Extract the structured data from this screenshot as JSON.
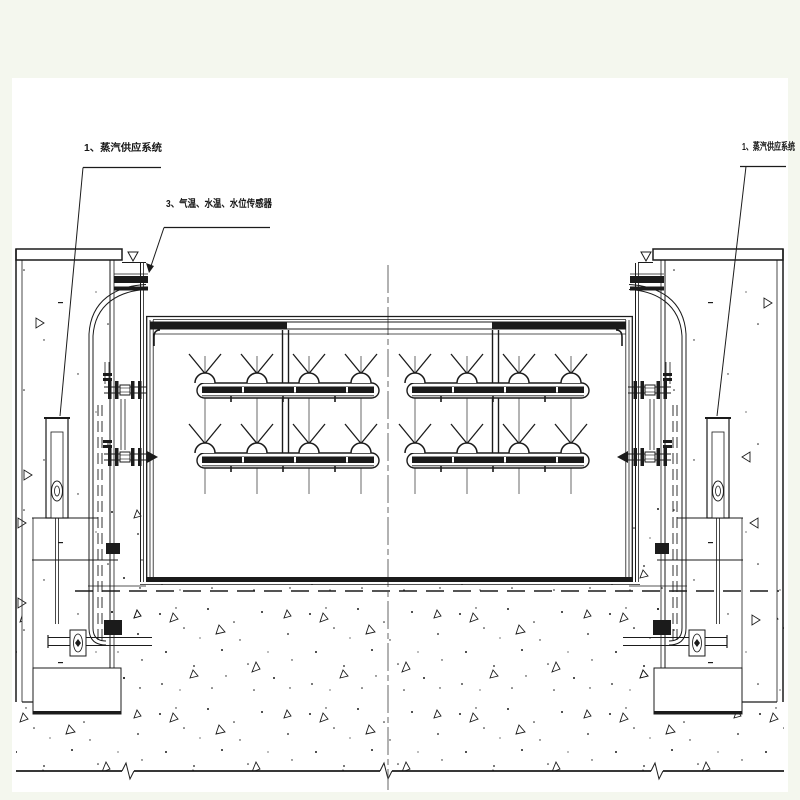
{
  "page": {
    "type": "engineering-cad-drawing",
    "colors": {
      "margin_background": "#f4f7ee",
      "paper": "#ffffff",
      "ink": "#1b1b1b",
      "centerline": "#555555"
    }
  },
  "drawing": {
    "callouts": {
      "left_steam_system": "1、蒸汽供应系统",
      "sensors": "3、气温、水温、水位传感器",
      "right_steam_system": "1、蒸汽供应系统"
    }
  }
}
